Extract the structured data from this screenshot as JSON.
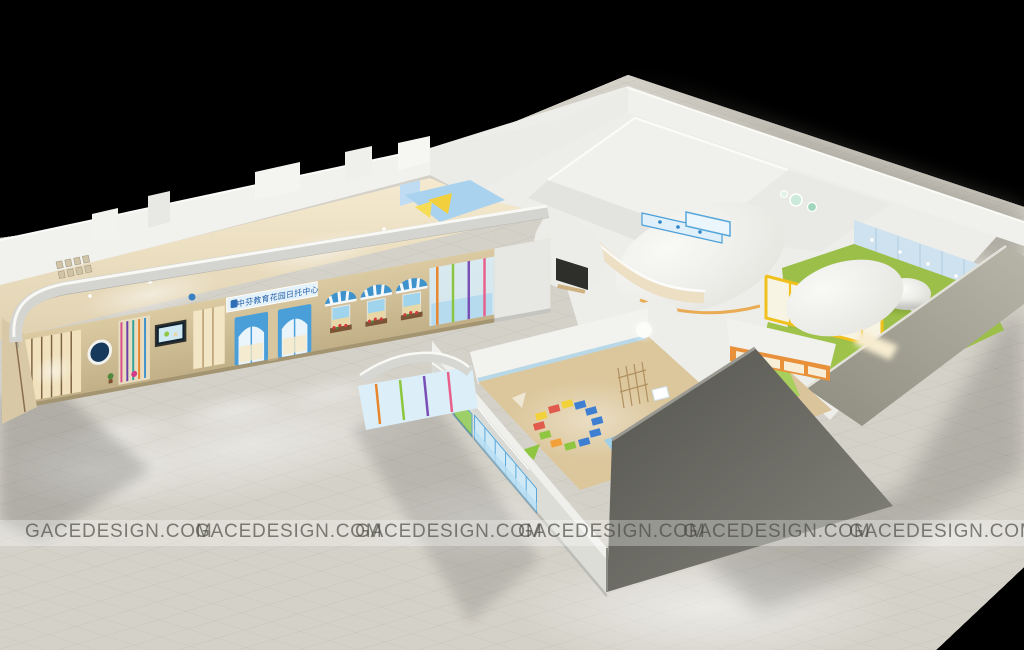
{
  "meta": {
    "type": "3d-architectural-rendering",
    "subject": "children education / daycare center interior, cutaway bird's-eye night render"
  },
  "watermark": {
    "text": "GACEDESIGN.COM",
    "items": [
      "GACEDESIGN.COM",
      "GACEDESIGN.COM",
      "GACEDESIGN.COM",
      "GACEDESIGN.COM",
      "GACEDESIGN.COM",
      "GACEDESIGN.COM"
    ]
  },
  "signage": {
    "text": "中芬教育花园日托中心"
  },
  "palette": {
    "background": "#000000",
    "ground": "#d6d4cb",
    "ground_far": "#8e8c7e",
    "building_white": "#f2f2ef",
    "facade_wood": "#d3c29c",
    "door_blue": "#58a7da",
    "awning_blue": "#3f93cc",
    "turf_green": "#a2c44e",
    "frame_yellow": "#f0c11c",
    "frame_orange": "#e8903a",
    "mat_blue": "#3f7fd1",
    "mat_red": "#e05a4e",
    "mat_yellow": "#f2d23a",
    "pond_blue": "#c2e6f0",
    "dark_wall": "#62625c",
    "sign_band": "#e6f2fa",
    "sign_text": "#1f5fa8"
  }
}
